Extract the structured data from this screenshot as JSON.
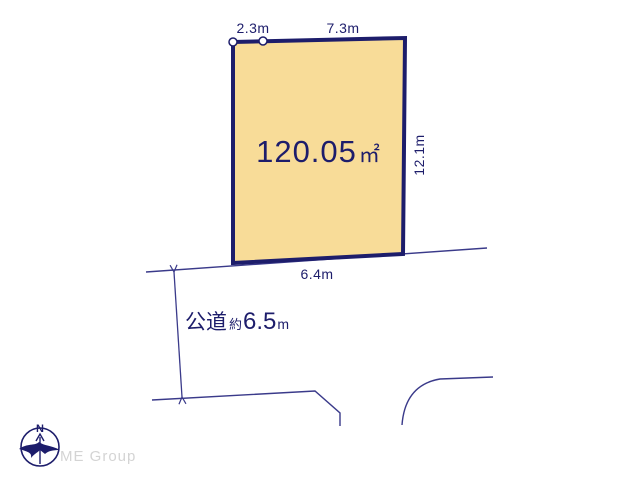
{
  "diagram": {
    "area": {
      "value": "120.05",
      "unit": "㎡"
    },
    "dimensions": {
      "top_left": "2.3m",
      "top_right": "7.3m",
      "right": "12.1m",
      "bottom": "6.4m"
    },
    "road": {
      "type_label": "公道",
      "approx_label": "約",
      "value": "6.5",
      "unit": "m"
    }
  },
  "compass": {
    "north": "N"
  },
  "branding": {
    "company": "ME Group"
  },
  "colors": {
    "navy": "#1d1d6b",
    "parcel_fill": "#f8dc98",
    "thin_line": "#3a3a8a",
    "logo_text_gray": "#d4d4d4"
  }
}
